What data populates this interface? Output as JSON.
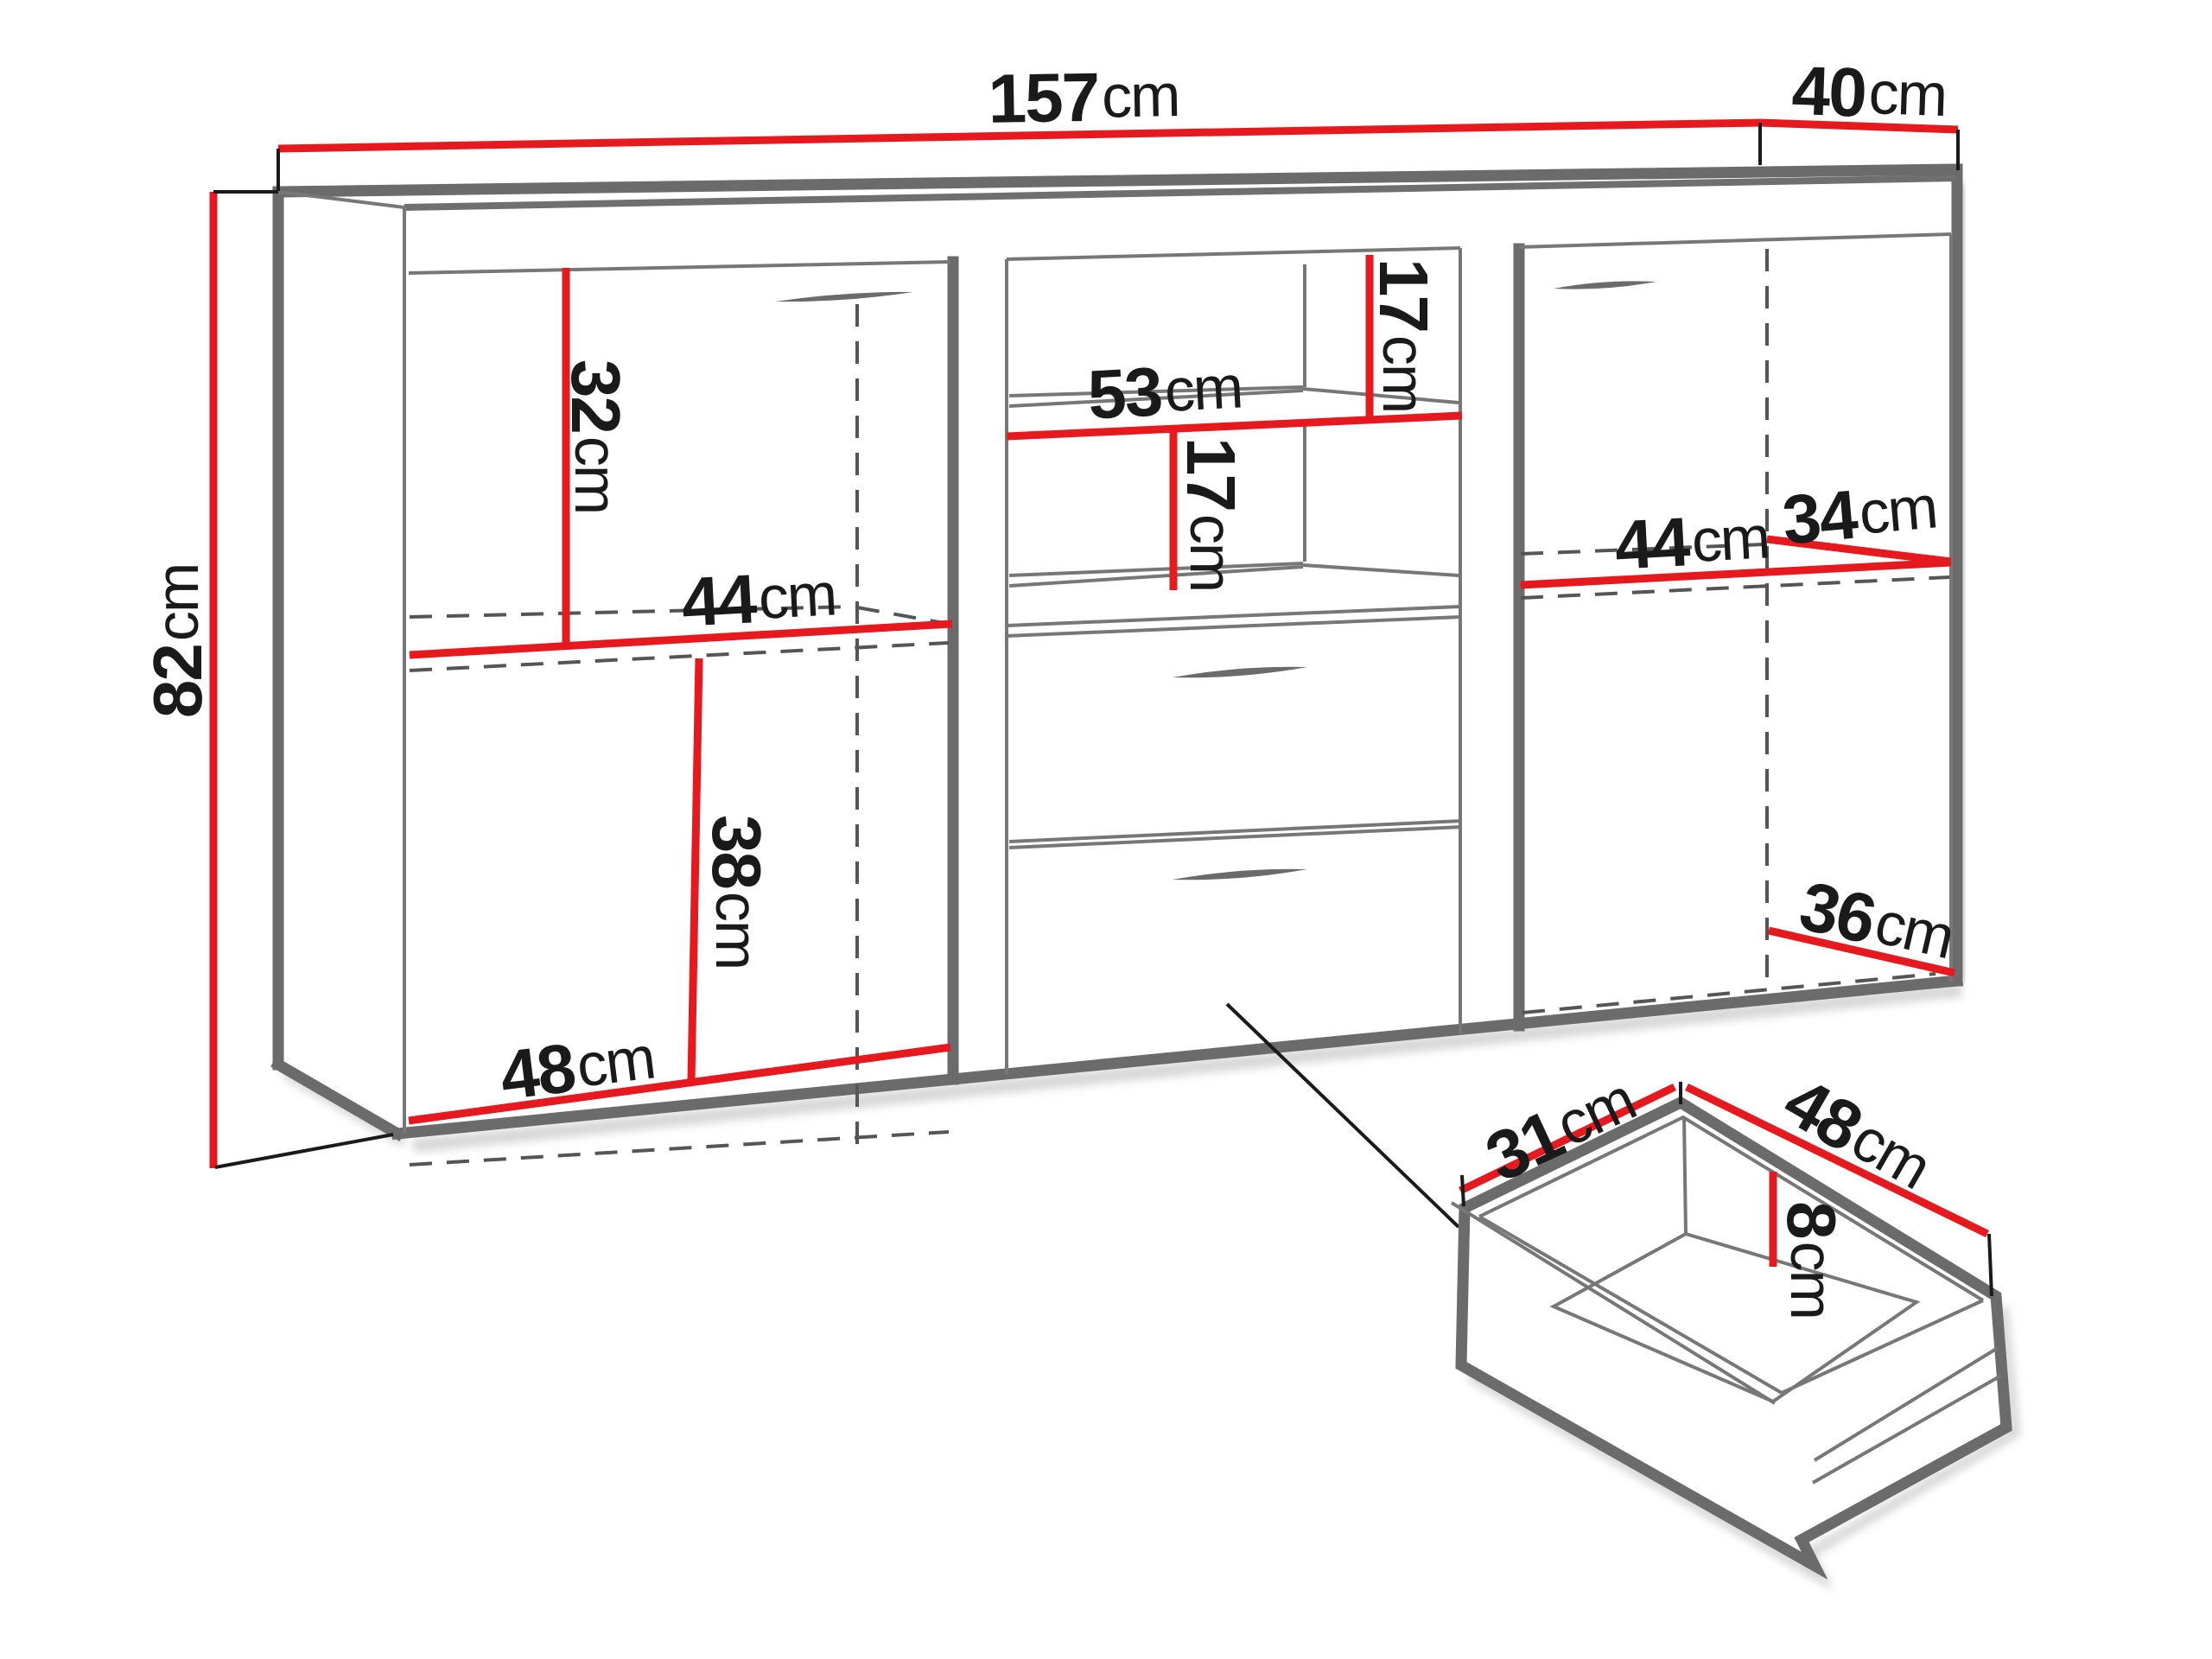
{
  "title": "Sideboard furniture dimension diagram",
  "unit": "cm",
  "colors": {
    "dimension_red": "#e6191e",
    "outline_gray": "#6b6b6b",
    "text_black": "#1a1a1a",
    "background": "#ffffff"
  },
  "dimensions": {
    "cabinet_width": {
      "value": "157",
      "unit": "cm"
    },
    "cabinet_depth": {
      "value": "40",
      "unit": "cm"
    },
    "cabinet_height": {
      "value": "82",
      "unit": "cm"
    },
    "left_upper_height": {
      "value": "32",
      "unit": "cm"
    },
    "left_shelf_width": {
      "value": "44",
      "unit": "cm"
    },
    "left_lower_height": {
      "value": "38",
      "unit": "cm"
    },
    "left_bottom_width": {
      "value": "48",
      "unit": "cm"
    },
    "middle_shelf_width": {
      "value": "53",
      "unit": "cm"
    },
    "middle_upper_gap": {
      "value": "17",
      "unit": "cm"
    },
    "middle_lower_gap": {
      "value": "17",
      "unit": "cm"
    },
    "right_shelf_width": {
      "value": "44",
      "unit": "cm"
    },
    "right_shelf_depth": {
      "value": "34",
      "unit": "cm"
    },
    "right_bottom_depth": {
      "value": "36",
      "unit": "cm"
    },
    "drawer_inner_depth": {
      "value": "31",
      "unit": "cm"
    },
    "drawer_inner_width": {
      "value": "48",
      "unit": "cm"
    },
    "drawer_inner_height": {
      "value": "8",
      "unit": "cm"
    }
  }
}
